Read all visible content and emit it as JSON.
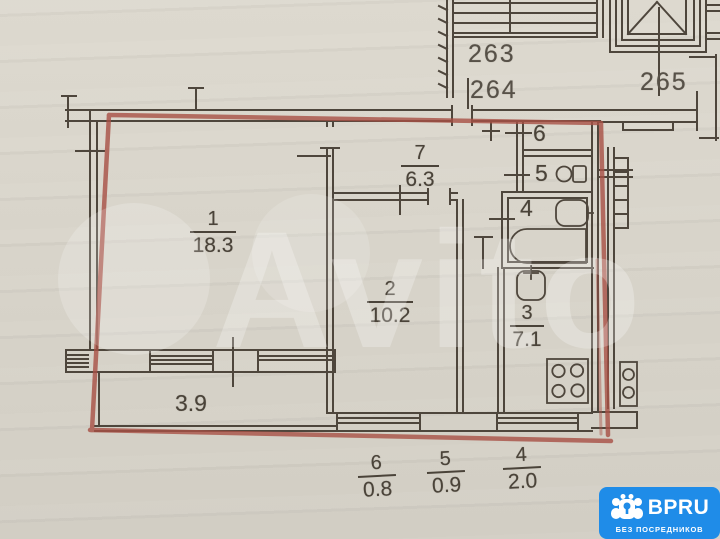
{
  "colors": {
    "paper": "#d8d4ca",
    "ink": "#4e463c",
    "red_outline": "#a85045",
    "badge_blue": "#1f8ce8"
  },
  "plan": {
    "unit_labels": [
      "263",
      "264",
      "265"
    ],
    "rooms": [
      {
        "number": "1",
        "area": "18.3"
      },
      {
        "number": "2",
        "area": "10.2"
      },
      {
        "number": "3",
        "area": "7.1"
      },
      {
        "number": "7",
        "area": "6.3"
      }
    ],
    "utility_rooms": [
      {
        "number": "6"
      },
      {
        "number": "5"
      },
      {
        "number": "4"
      }
    ],
    "balcony_area": "3.9",
    "annex_fractions": [
      {
        "number": "6",
        "area": "0.8"
      },
      {
        "number": "5",
        "area": "0.9"
      },
      {
        "number": "4",
        "area": "2.0"
      }
    ]
  },
  "watermark": {
    "text": "Avito"
  },
  "badge": {
    "title": "BPRU",
    "subtitle": "БЕЗ ПОСРЕДНИКОВ"
  }
}
